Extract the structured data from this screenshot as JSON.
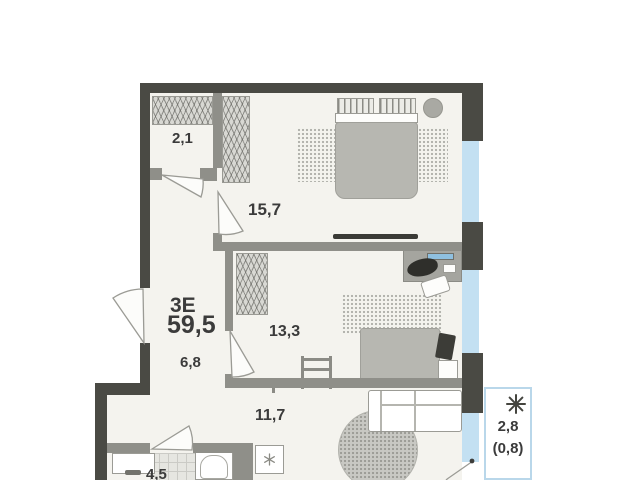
{
  "plan_title": {
    "type": "3Е",
    "total_area": "59,5"
  },
  "rooms": {
    "closet": {
      "area": "2,1"
    },
    "bedroom_main": {
      "area": "15,7"
    },
    "hallway": {
      "area": "6,8"
    },
    "bedroom_second": {
      "area": "13,3"
    },
    "kitchen_living": {
      "area": "11,7"
    },
    "bathroom": {
      "area": "4,5"
    },
    "balcony": {
      "area": "2,8",
      "area_with_coefficient": "(0,8)"
    }
  },
  "icons": {
    "balcony": "snowflake-icon",
    "washing_machine": "asterisk-icon"
  },
  "colors": {
    "background": "#ffffff",
    "floor": "#f4f3ee",
    "wall_exterior": "#4a4a44",
    "wall_interior": "#8f8f89",
    "window_glazing": "#c3e0f2",
    "balcony_border": "#b9d7ea",
    "furniture_outline": "#9b9b95",
    "furniture_gray": "#b7b7b1",
    "monitor_screen": "#8fc0e0",
    "text": "#3b3b3b"
  }
}
